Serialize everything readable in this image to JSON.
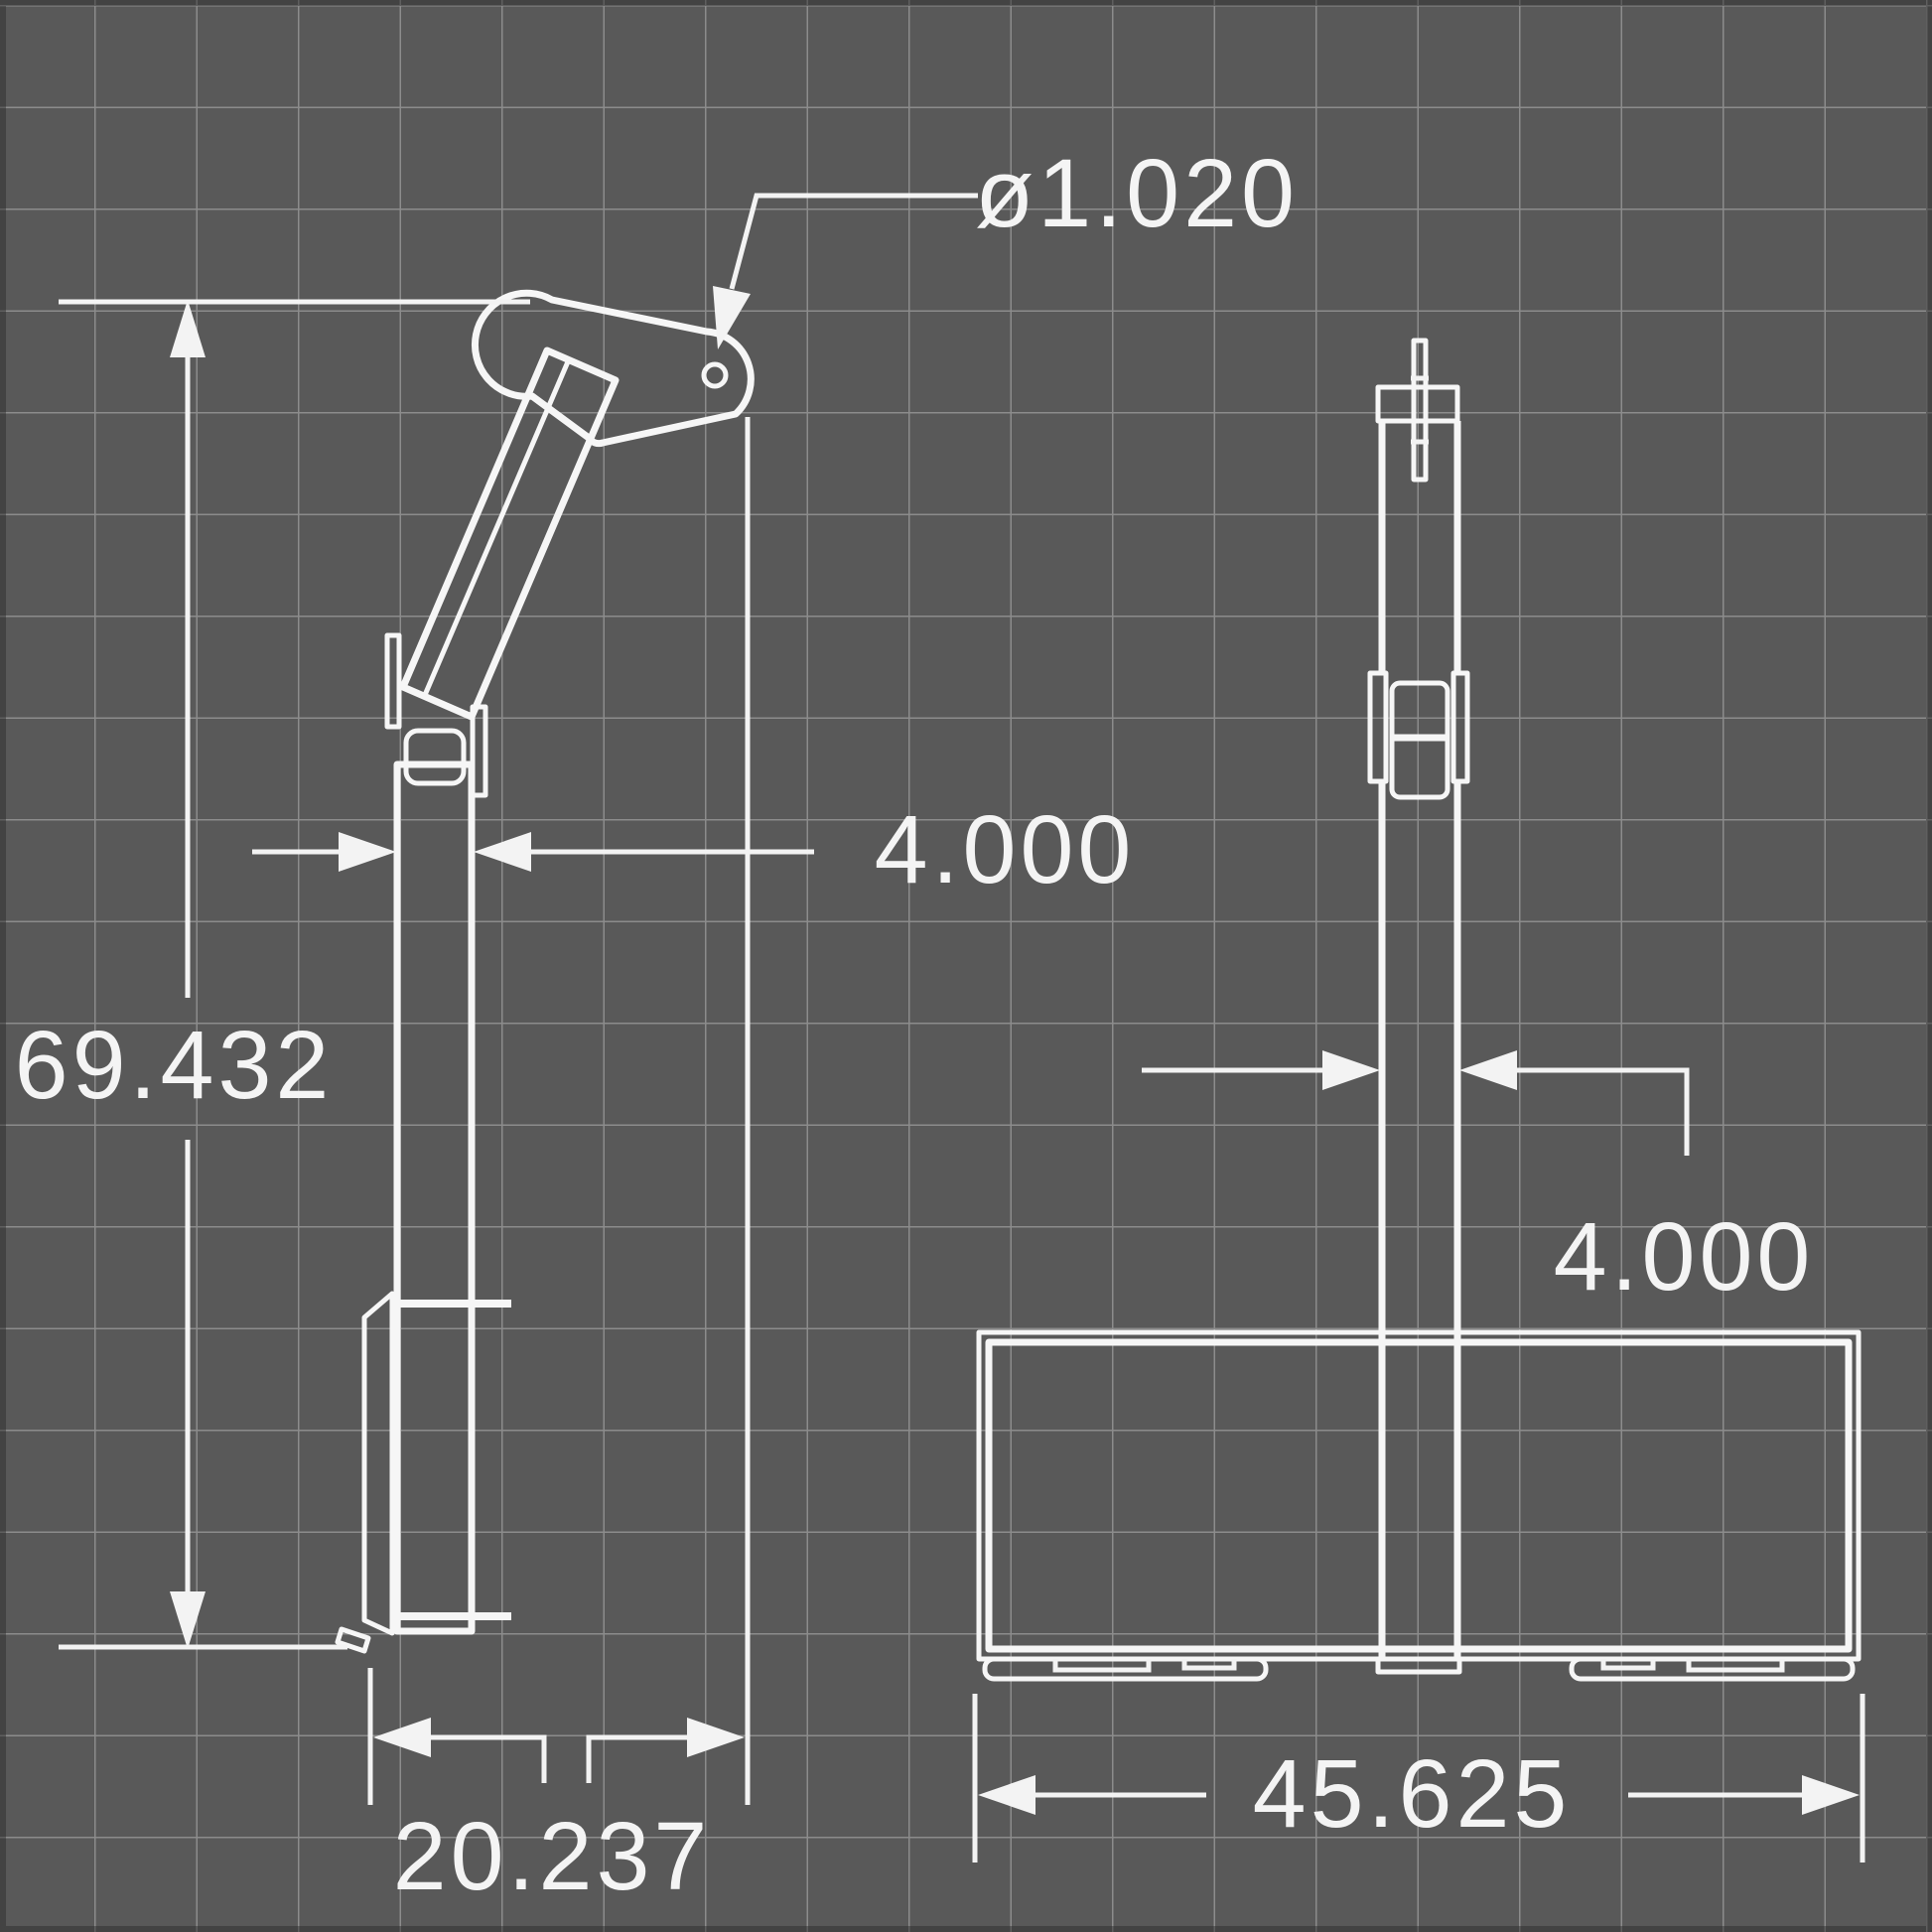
{
  "drawing": {
    "type": "technical-dimension-drawing",
    "description": "Two-view outline drawing of a skid steer tree/post boom attachment on a dark grid background",
    "colors": {
      "background": "#595959",
      "grid_line": "#8c8c8c",
      "drawing_line": "#f6f6f6",
      "label_text": "#f4f4f4"
    },
    "side_view": {
      "hole_diameter": "ø1.020",
      "post_width": "4.000",
      "overall_height": "69.432",
      "base_depth": "20.237"
    },
    "front_view": {
      "post_width": "4.000",
      "base_width": "45.625"
    }
  }
}
